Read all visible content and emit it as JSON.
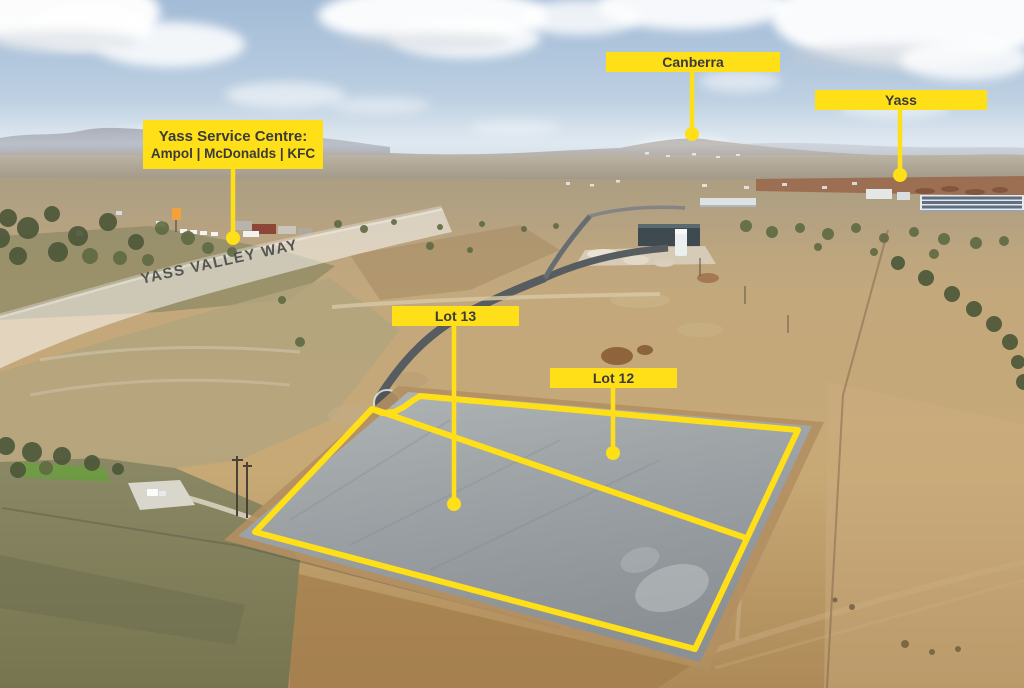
{
  "labels": {
    "canberra": "Canberra",
    "yass": "Yass",
    "service_centre_title": "Yass Service Centre:",
    "service_centre_subtitle": "Ampol | McDonalds | KFC",
    "lot_13": "Lot 13",
    "lot_12": "Lot 12",
    "road_name": "YASS VALLEY WAY"
  },
  "colors": {
    "label_bg": "#FFDF17",
    "label_text": "#3B3B3B",
    "outline": "#FFDF17",
    "road_text": "#4F4F4F"
  }
}
